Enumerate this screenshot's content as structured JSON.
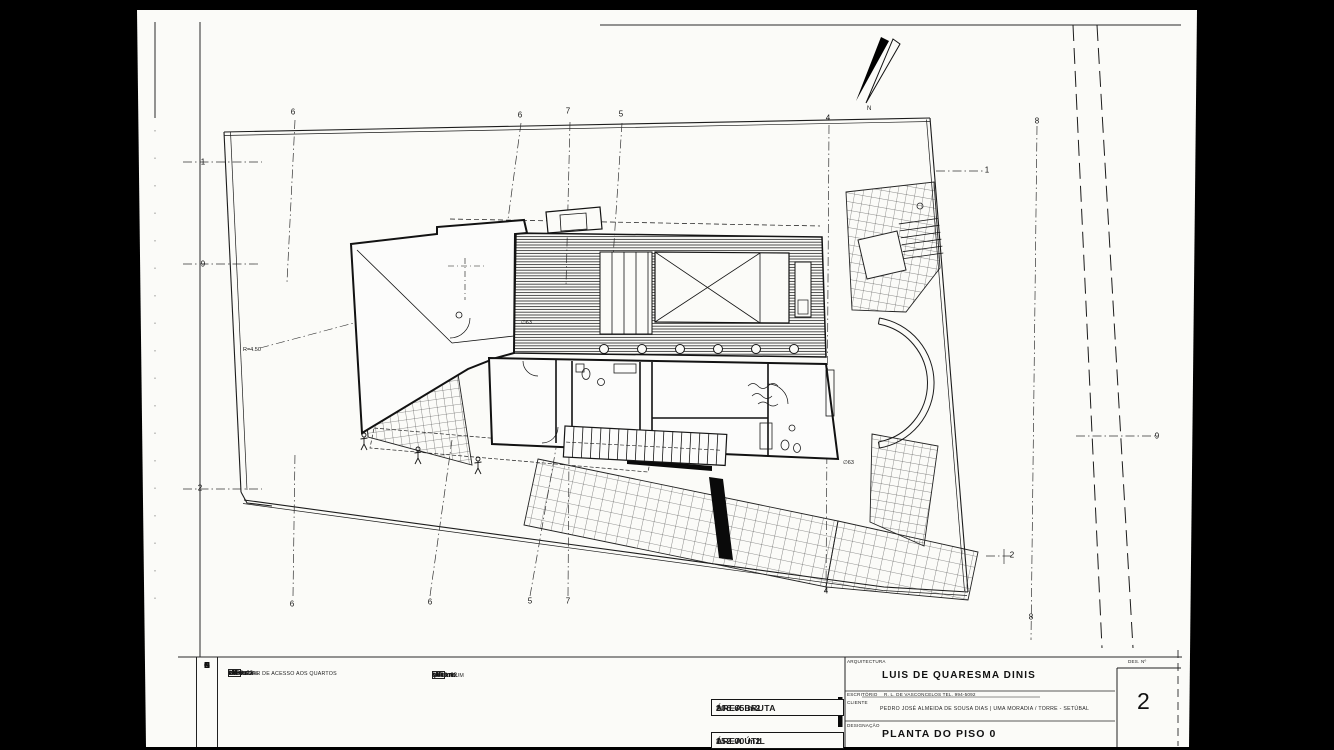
{
  "title_block": {
    "architecture_label": "ARQUITECTURA",
    "architect_name": "LUIS DE QUARESMA DINIS",
    "office_label": "ESCRITÓRIO",
    "office_info": "R. L. DE VASCONCELOS  TEL. 994-5092",
    "client_label": "CLIENTE",
    "client_info": "PEDRO JOSÉ ALMEIDA DE SOUSA DIAS | UMA MORADIA / TORRE - SETÚBAL",
    "designation_label": "DESIGNAÇÃO",
    "drawing_title": "PLANTA DO PISO 0",
    "sheet_number_label": "DES. Nº",
    "sheet_number": "2"
  },
  "areas": {
    "gross_label": "ÁREA BRUTA",
    "gross_eq": "=",
    "gross_value": "206.65 m2",
    "net_label": "ÁREA ÚTIL",
    "net_eq": "=",
    "net_value": "152.00 m2"
  },
  "legend": {
    "title_letters": [
      "L",
      "E",
      "G",
      "E",
      "N",
      "D",
      "A"
    ],
    "column1": [
      {
        "num": "03",
        "name": "HALL",
        "area": "4.35 m2"
      },
      {
        "num": "04",
        "name": "SALA",
        "area": "43.35 m2"
      },
      {
        "num": "05",
        "name": "COZINHA",
        "area": "15.05 m2"
      },
      {
        "num": "06",
        "name": "I.S. SOCIAL",
        "area": "1.55 m2"
      },
      {
        "num": "07",
        "name": "CORREDOR DE ACESSO AOS QUARTOS",
        "area": "22.96 m2"
      }
    ],
    "column2": [
      {
        "num": "08",
        "name": "QUARTO",
        "area": "17.25 m2"
      },
      {
        "num": "09",
        "name": "I.S. COMUM",
        "area": "8.25 m2"
      },
      {
        "num": "10",
        "name": "QUARTO",
        "area": "16.90 m2"
      },
      {
        "num": "11",
        "name": "QUARTO",
        "area": "18.16 m2"
      },
      {
        "num": "12",
        "name": "I.S.",
        "area": "4.60 m2"
      }
    ]
  },
  "plan": {
    "north_label": "N",
    "grid_marks": [
      {
        "label": "1",
        "x": 203,
        "y": 162
      },
      {
        "label": "9",
        "x": 203,
        "y": 264
      },
      {
        "label": "2",
        "x": 200,
        "y": 488
      },
      {
        "label": "6",
        "x": 293,
        "y": 112
      },
      {
        "label": "6",
        "x": 520,
        "y": 115
      },
      {
        "label": "7",
        "x": 568,
        "y": 111
      },
      {
        "label": "5",
        "x": 621,
        "y": 114
      },
      {
        "label": "4",
        "x": 828,
        "y": 118
      },
      {
        "label": "8",
        "x": 1037,
        "y": 121
      },
      {
        "label": "1",
        "x": 987,
        "y": 170
      },
      {
        "label": "9",
        "x": 1157,
        "y": 436
      },
      {
        "label": "2",
        "x": 1012,
        "y": 555
      },
      {
        "label": "6",
        "x": 292,
        "y": 604
      },
      {
        "label": "6",
        "x": 430,
        "y": 602
      },
      {
        "label": "5",
        "x": 530,
        "y": 601
      },
      {
        "label": "7",
        "x": 568,
        "y": 601
      },
      {
        "label": "4",
        "x": 826,
        "y": 591
      },
      {
        "label": "8",
        "x": 1031,
        "y": 617
      }
    ],
    "annotations": [
      {
        "text": "R=4.50",
        "x": 243,
        "y": 347
      },
      {
        "text": "∅63",
        "x": 521,
        "y": 320
      },
      {
        "text": "∅63",
        "x": 843,
        "y": 460
      }
    ],
    "colors": {
      "paper": "#fbfbf8",
      "ink": "#1a1a1a",
      "background": "#000000"
    }
  }
}
